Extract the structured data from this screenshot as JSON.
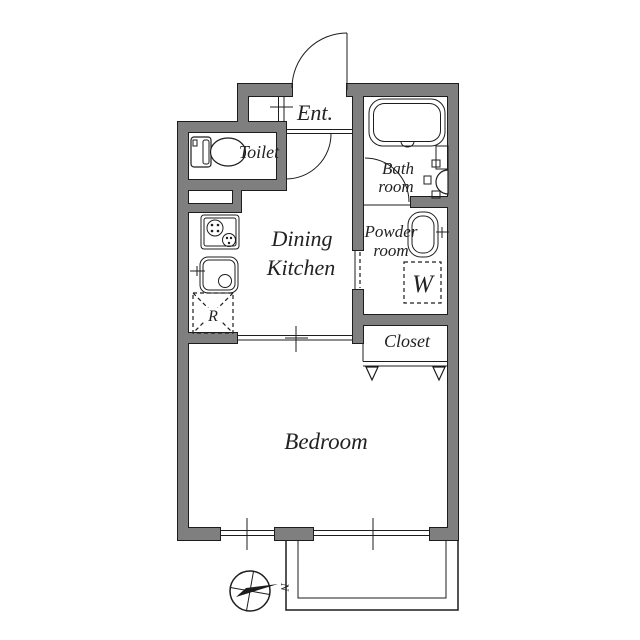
{
  "colors": {
    "wall": "#7f7f7f",
    "line": "#1d1d1d",
    "text": "#222222",
    "background": "#ffffff"
  },
  "rooms": {
    "entrance": {
      "label": "Ent."
    },
    "toilet": {
      "label": "Toilet"
    },
    "bath_room": {
      "line1": "Bath",
      "line2": "room"
    },
    "powder_room": {
      "line1": "Powder",
      "line2": "room"
    },
    "dining_kitchen": {
      "line1": "Dining",
      "line2": "Kitchen"
    },
    "closet": {
      "label": "Closet"
    },
    "bedroom": {
      "label": "Bedroom"
    }
  },
  "symbols": {
    "refrigerator": "R",
    "washing_machine": "W",
    "compass_north": "N"
  }
}
